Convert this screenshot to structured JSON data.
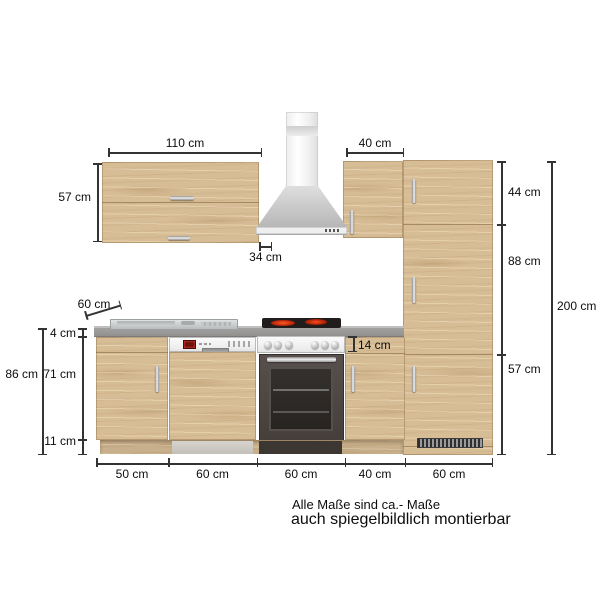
{
  "diagram": {
    "title": "kitchen-unit-dimension-drawing",
    "note_line1": "Alle Maße sind ca.- Maße",
    "note_line2": "auch spiegelbildlich montierbar"
  },
  "dims": {
    "wall_left_width": "110 cm",
    "wall_right_width": "40 cm",
    "wall_height": "57 cm",
    "wall_depth": "34 cm",
    "counter_depth": "60 cm",
    "counter_thickness": "4 cm",
    "base_carcass_height": "71 cm",
    "plinth_height": "11 cm",
    "base_total_height": "86 cm",
    "drawer_front_height": "14 cm",
    "tall_top": "44 cm",
    "tall_middle": "88 cm",
    "tall_bottom": "57 cm",
    "tall_total": "200 cm",
    "base_widths": [
      "50 cm",
      "60 cm",
      "60 cm",
      "40 cm",
      "60 cm"
    ]
  },
  "colors": {
    "wood": "#d7bd96",
    "counter": "#9d9c9a",
    "steel": "#cfcfcf",
    "oven_front": "#4c4541",
    "burner_red": "#cc2a12",
    "dim_line": "#333333"
  }
}
